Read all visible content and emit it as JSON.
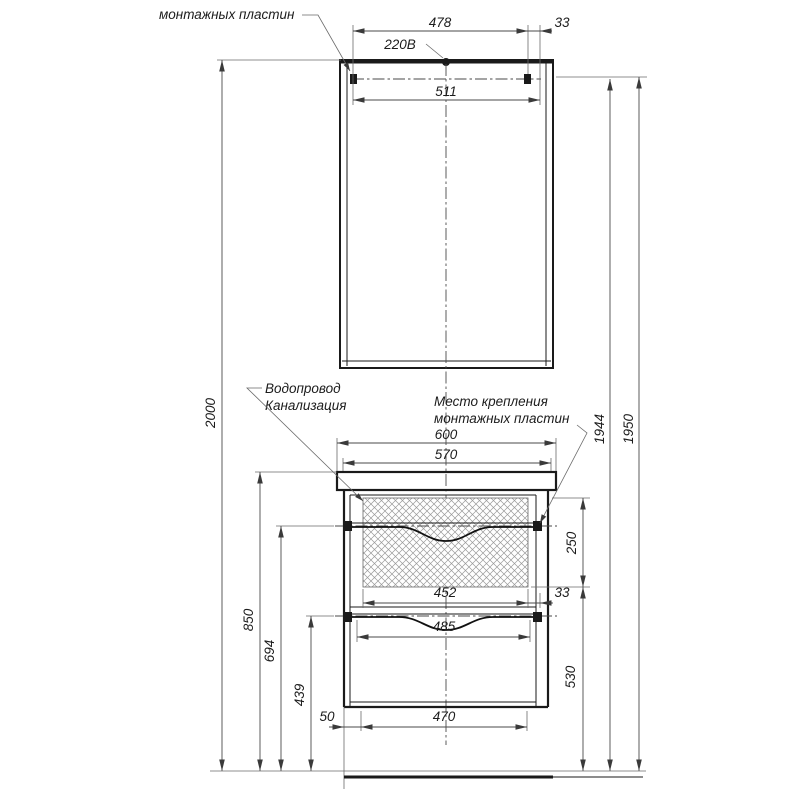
{
  "annotations": {
    "mounting_plates_top": "монтажных пластин",
    "power_outlet": "220В",
    "water_supply": "Водопровод",
    "sewerage": "Канализация",
    "mounting_location_line1": "Место крепления",
    "mounting_location_line2": "монтажных пластин"
  },
  "dimensions": {
    "mirror_mount_span": "478",
    "mirror_mount_offset": "33",
    "mirror_width": "511",
    "cabinet_width": "600",
    "cabinet_inner_width": "570",
    "sink_cutout_width": "452",
    "sink_cutout_offset": "33",
    "drawer_width": "485",
    "bottom_offset": "50",
    "bottom_width": "470",
    "total_height": "2000",
    "countertop_height": "850",
    "upper_mount_height": "694",
    "lower_mount_height": "439",
    "drawer_zone_height": "250",
    "lower_zone_height": "530",
    "mirror_mount_height": "1944",
    "mirror_top_height": "1950"
  },
  "colors": {
    "line": "#1a1a1a",
    "dim_line": "#4a4a4a",
    "background": "#ffffff"
  }
}
